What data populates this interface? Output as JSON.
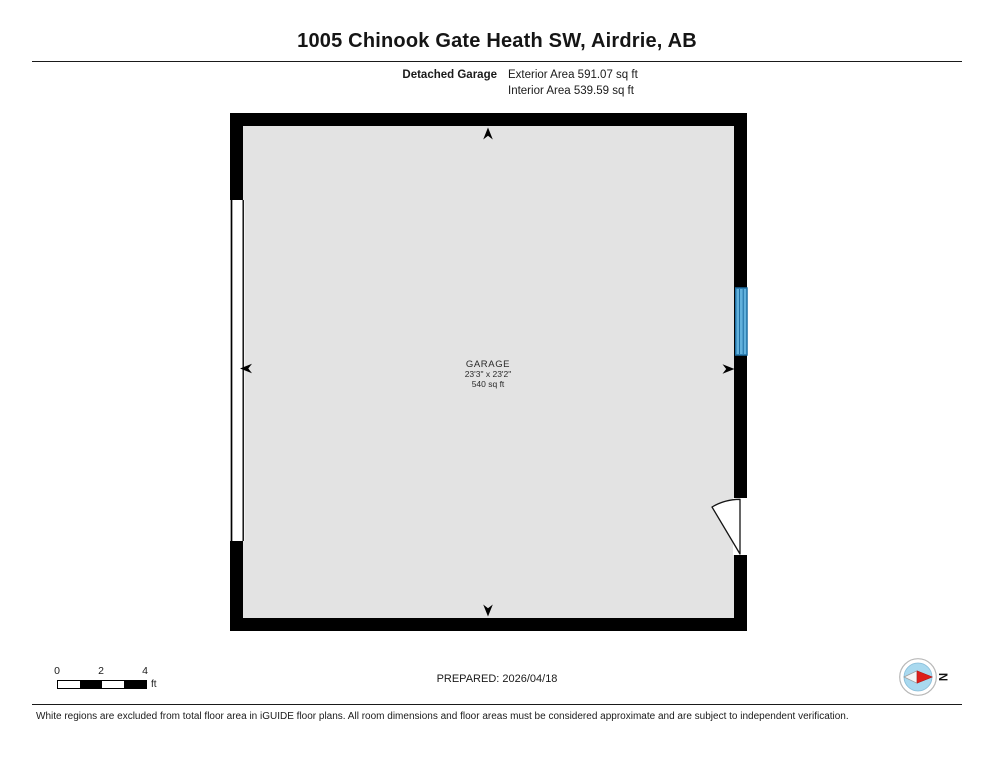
{
  "page": {
    "title": "1005 Chinook Gate Heath SW, Airdrie, AB",
    "floor_label": "Detached Garage",
    "exterior_area": "Exterior Area 591.07 sq ft",
    "interior_area": "Interior Area 539.59 sq ft",
    "prepared": "PREPARED: 2026/04/18",
    "disclaimer": "White regions are excluded from total floor area in iGUIDE floor plans. All room dimensions and floor areas must be considered approximate and are subject to independent verification."
  },
  "room": {
    "name": "GARAGE",
    "dimensions": "23'3\" x 23'2\"",
    "area": "540 sq ft"
  },
  "scale_bar": {
    "ticks": [
      "0",
      "2",
      "4"
    ],
    "unit": "ft"
  },
  "compass": {
    "label": "N"
  },
  "colors": {
    "wall": "#000000",
    "floor_fill": "#e3e3e3",
    "window_fill": "#62b1dc",
    "window_border": "#1e6fa4",
    "compass_inner": "#a9d9ef",
    "needle_red": "#dd1f1a"
  }
}
